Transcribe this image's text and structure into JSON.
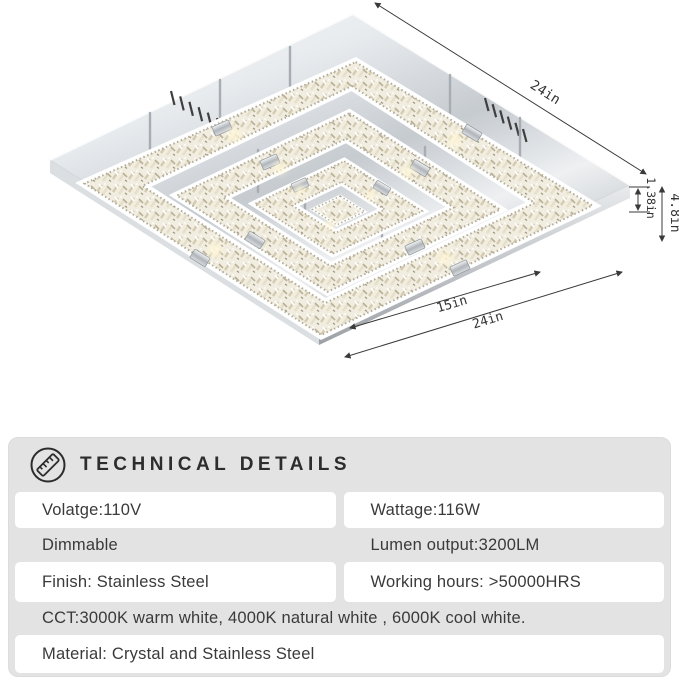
{
  "diagram": {
    "name": "crystal-ceiling-light-dimension-diagram",
    "dimensions": {
      "top_edge": "24in",
      "thickness": "1.38in",
      "height": "4.8in",
      "inner_width": "15in",
      "outer_width": "24in"
    }
  },
  "panel": {
    "title": "TECHNICAL DETAILS",
    "icon": "ruler-icon",
    "specs": {
      "voltage": "Volatge:110V",
      "wattage": "Wattage:116W",
      "dimmable": "Dimmable",
      "lumen_output": "Lumen output:3200LM",
      "finish": "Finish: Stainless Steel",
      "working_hours": "Working hours: >50000HRS",
      "cct": "CCT:3000K warm white, 4000K natural white , 6000K cool white.",
      "material": "Material: Crystal and Stainless Steel"
    },
    "colors": {
      "panel_bg": "#e3e3e3",
      "cell_bg": "#ffffff",
      "text": "#3a3a3a",
      "title": "#2d2d2d"
    }
  }
}
